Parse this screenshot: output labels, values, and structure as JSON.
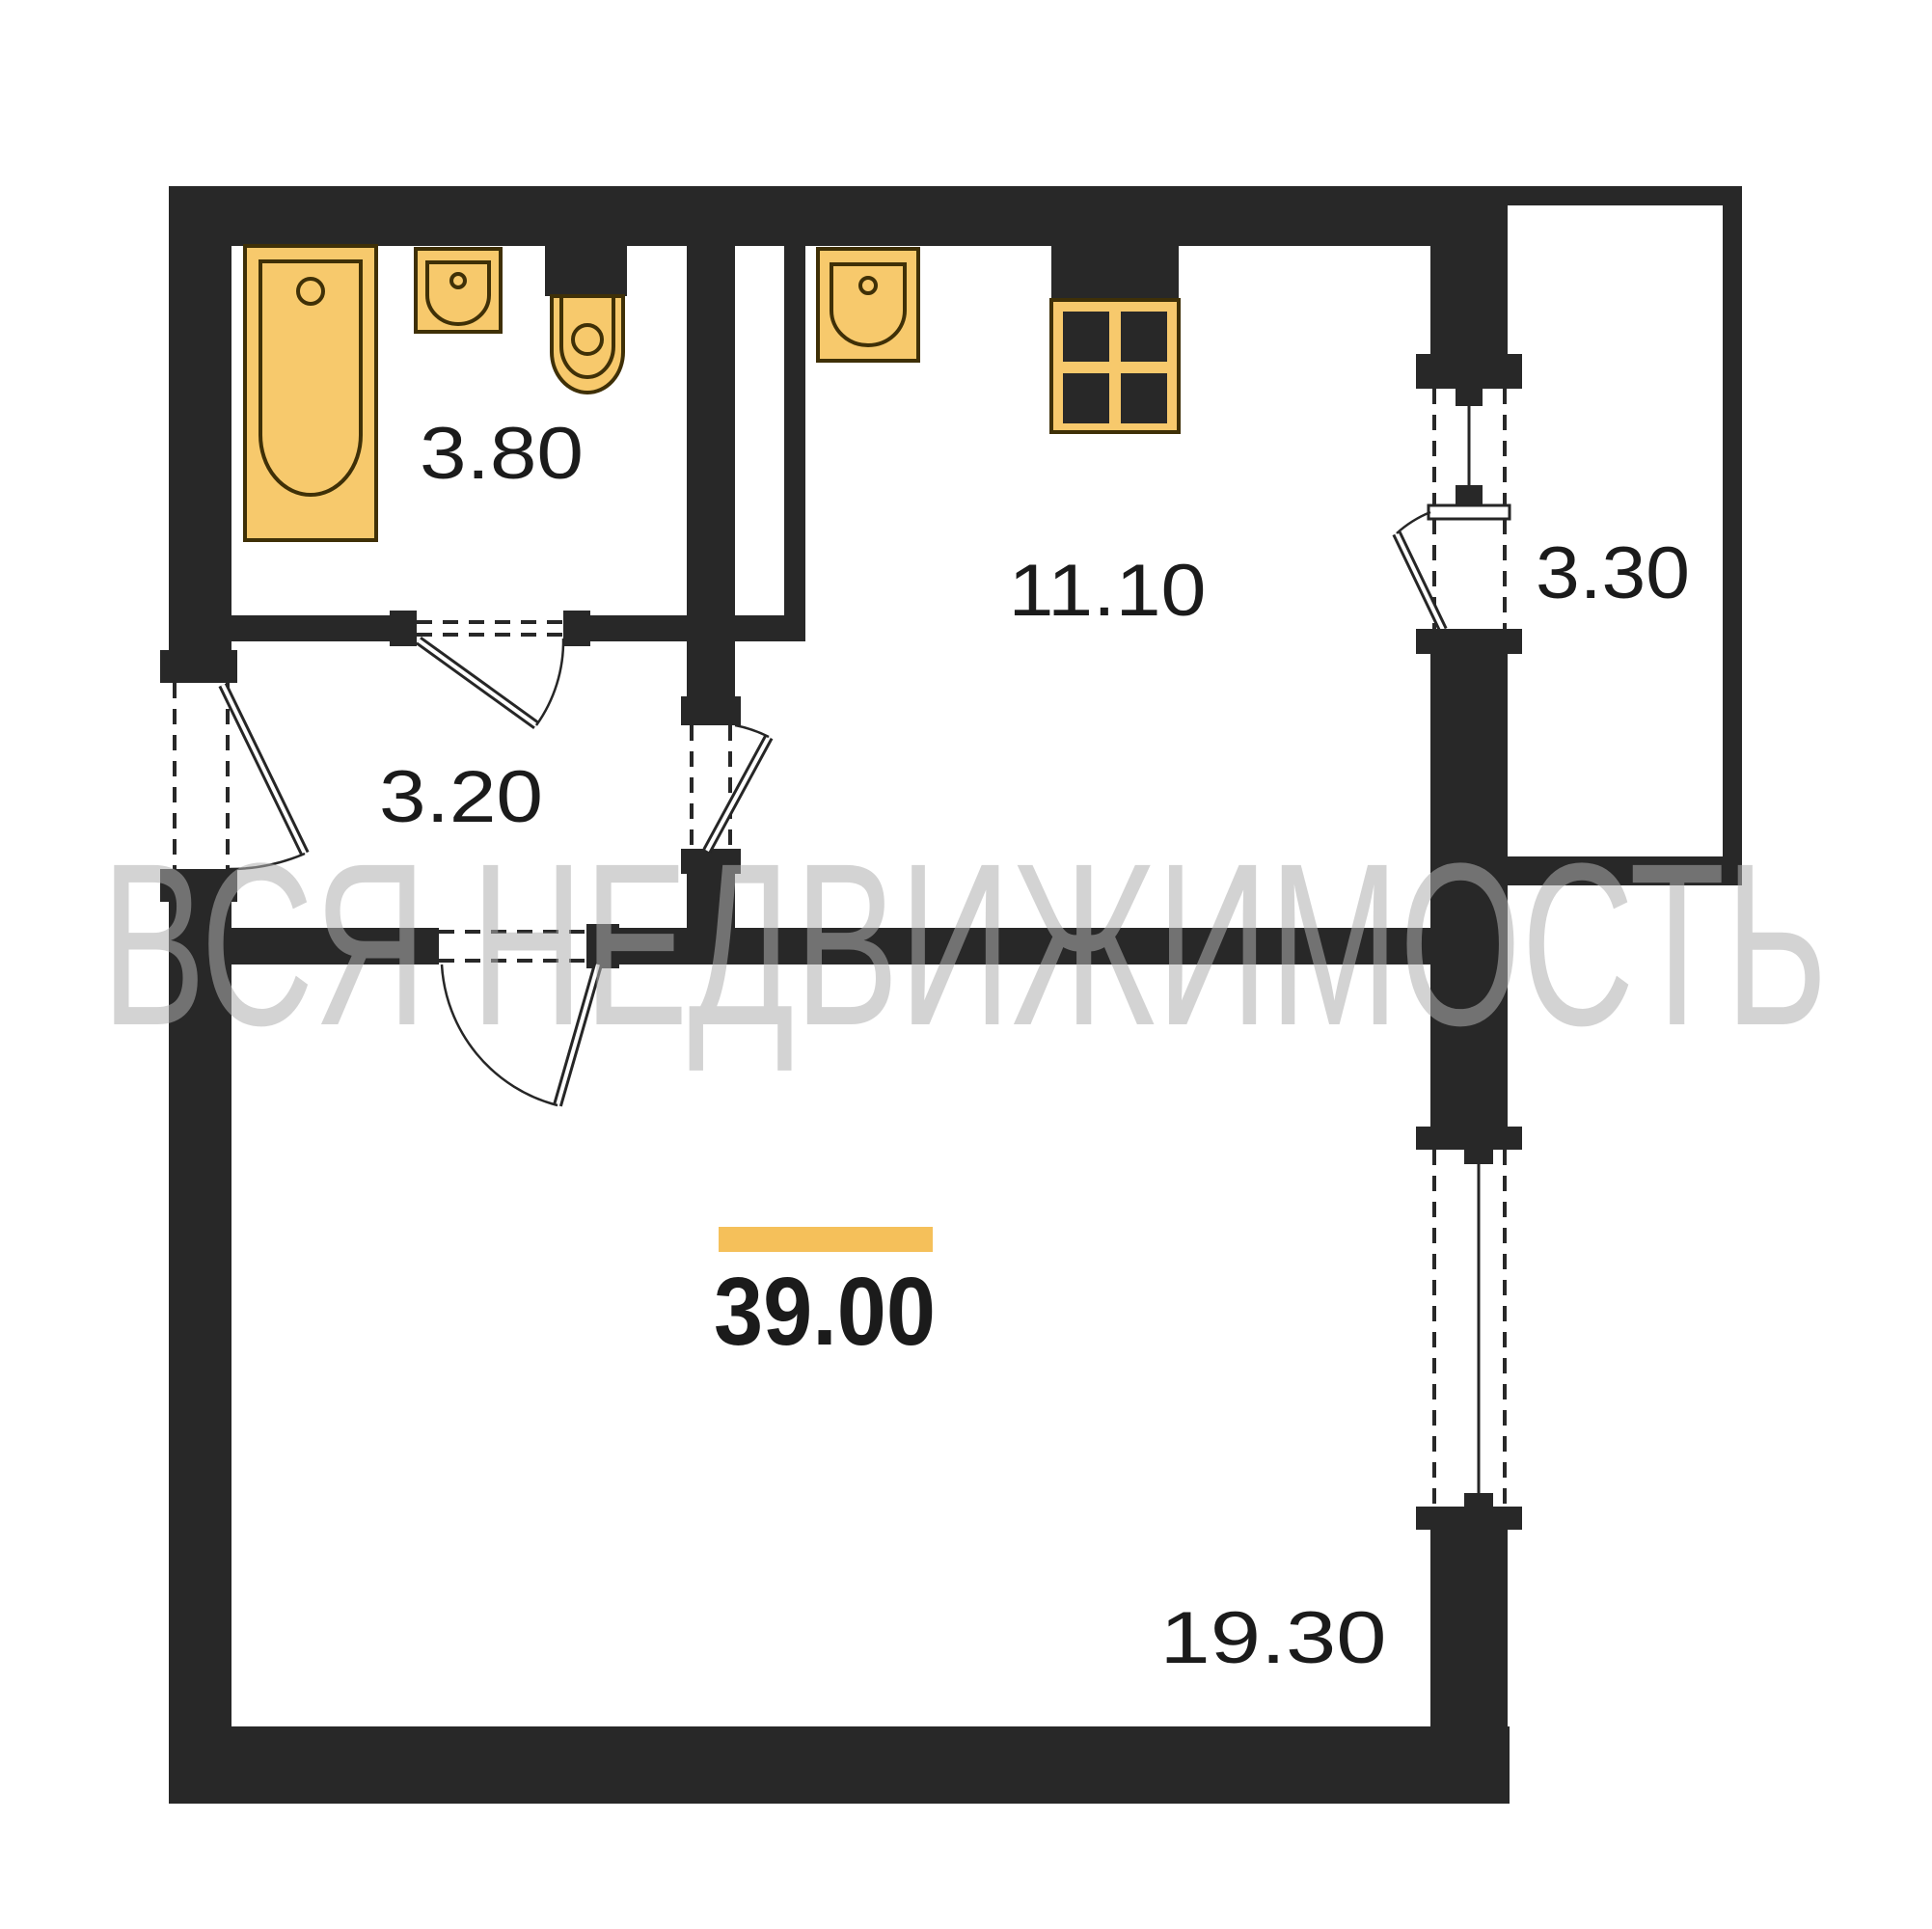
{
  "colors": {
    "wall": "#282828",
    "line": "#262626",
    "fixture": "#f7c96c",
    "fixture_border": "#3f3007",
    "accent": "#f5c05a",
    "label": "#1b1b1b",
    "watermark": "#b0b0b0",
    "background": "#ffffff"
  },
  "watermark": {
    "text": "ВСЯ НЕДВИЖИМОСТЬ"
  },
  "total_area": "39.00",
  "rooms": [
    {
      "id": "bathroom",
      "area": "3.80"
    },
    {
      "id": "hallway",
      "area": "3.20"
    },
    {
      "id": "kitchen",
      "area": "11.10"
    },
    {
      "id": "balcony",
      "area": "3.30"
    },
    {
      "id": "living-room",
      "area": "19.30"
    }
  ],
  "fixtures": [
    "bathtub",
    "bathroom-sink",
    "toilet",
    "kitchen-sink",
    "stove"
  ]
}
